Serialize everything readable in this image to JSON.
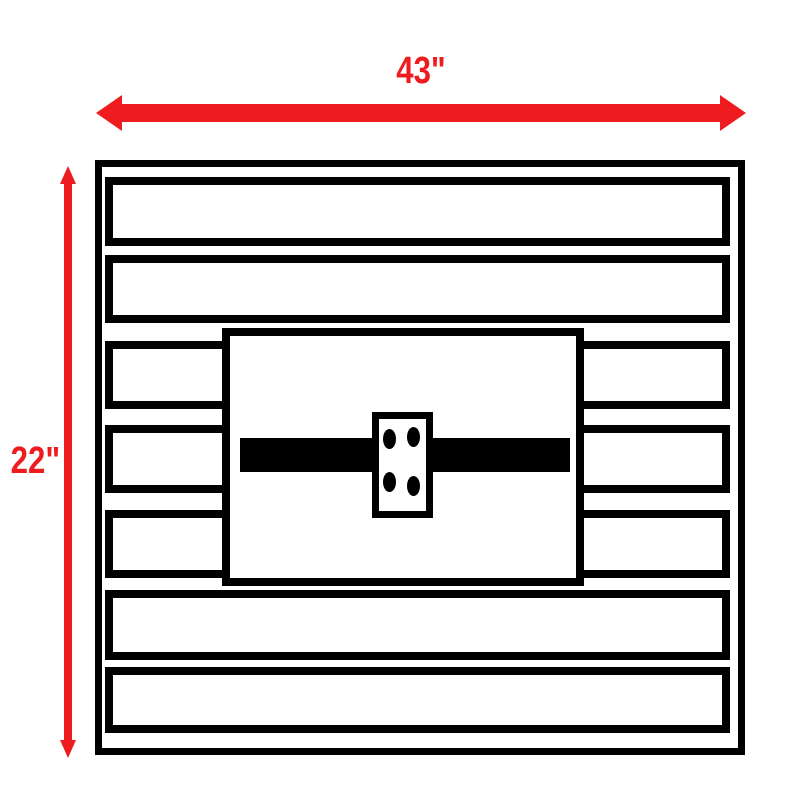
{
  "diagram": {
    "width_label": "43\"",
    "height_label": "22\"",
    "slat_count": 7,
    "bolt_hole_count": 4
  },
  "colors": {
    "dimension_accent": "#ee1c1e",
    "line": "#000000",
    "background": "#ffffff"
  }
}
